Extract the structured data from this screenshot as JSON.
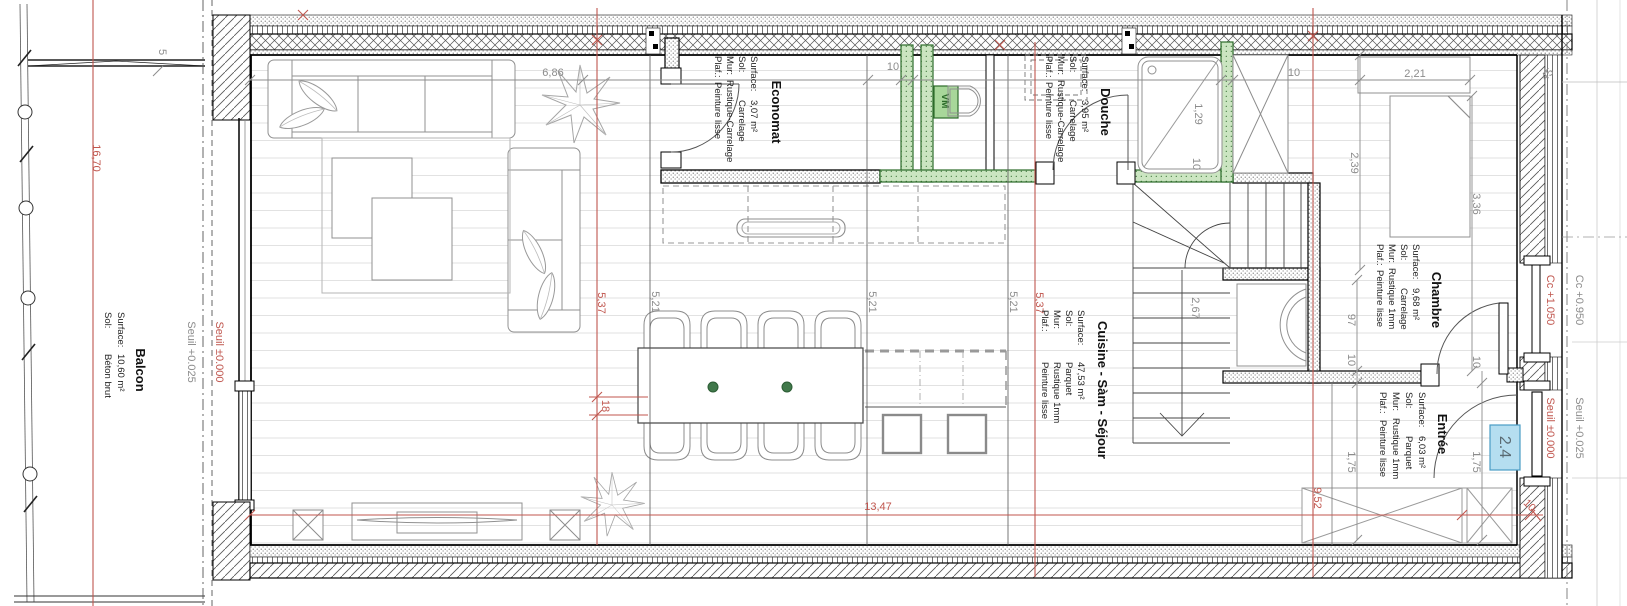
{
  "plan": {
    "rooms": {
      "balcon": {
        "title": "Balcon",
        "rows": [
          {
            "label": "Surface:",
            "value": "10,60 m²"
          },
          {
            "label": "Sol:",
            "value": "Béton brut"
          }
        ]
      },
      "economat": {
        "title": "Economat",
        "rows": [
          {
            "label": "Surface:",
            "value": "3,07 m²"
          },
          {
            "label": "Sol:",
            "value": "Carrelage"
          },
          {
            "label": "Mur:",
            "value": "Rustique-Carrelage"
          },
          {
            "label": "Plaf.:",
            "value": "Peinture lisse"
          }
        ]
      },
      "douche": {
        "title": "Douche",
        "rows": [
          {
            "label": "Surface:",
            "value": "3,95 m²"
          },
          {
            "label": "Sol:",
            "value": "Carrelage"
          },
          {
            "label": "Mur:",
            "value": "Rustique-Carrelage"
          },
          {
            "label": "Plaf.:",
            "value": "Peinture lisse"
          }
        ]
      },
      "cuisine": {
        "title": "Cuisine - Sàm - Séjour",
        "rows": [
          {
            "label": "Surface:",
            "value": "47,53 m²"
          },
          {
            "label": "Sol:",
            "value": "Parquet"
          },
          {
            "label": "Mur:",
            "value": "Rustique 1mm"
          },
          {
            "label": "Plaf.:",
            "value": "Peinture lisse"
          }
        ]
      },
      "chambre": {
        "title": "Chambre",
        "rows": [
          {
            "label": "Surface:",
            "value": "9,68 m²"
          },
          {
            "label": "Sol:",
            "value": "Carrelage"
          },
          {
            "label": "Mur:",
            "value": "Rustique 1mm"
          },
          {
            "label": "Plaf.:",
            "value": "Peinture lisse"
          }
        ]
      },
      "entree": {
        "title": "Entrée",
        "rows": [
          {
            "label": "Surface:",
            "value": "6,03 m²"
          },
          {
            "label": "Sol:",
            "value": "Parquet"
          },
          {
            "label": "Mur:",
            "value": "Rustique 1mm"
          },
          {
            "label": "Plaf.:",
            "value": "Peinture lisse"
          }
        ]
      }
    },
    "levels": {
      "left_gray": "Seuil +0.025",
      "left_red": "Seuil ±0.000",
      "window_red": "Cc +1.050",
      "window_gray": "Cc +0.950",
      "door_red": "Seuil ±0.000",
      "door_gray": "Seuil +0.025"
    },
    "tags": {
      "door": "2.4",
      "vm": "VM"
    },
    "dims_gray": {
      "d5": "5",
      "d686": "6,86",
      "d10_a": "10",
      "d10_b": "10",
      "d129": "1,29",
      "d10_tray": "10",
      "d221": "2,21",
      "d239": "2,39",
      "d336": "3,36",
      "d45": "45",
      "d521_1": "5,21",
      "d521_2": "5,21",
      "d521_3": "5,21",
      "d267": "2,67",
      "d97": "97",
      "d10_c": "10",
      "d10_d": "10",
      "d175_1": "1,75",
      "d175_2": "1,75"
    },
    "dims_red": {
      "d1670": "16,70",
      "d537_1": "5,37",
      "d537_2": "5,37",
      "d18": "18",
      "d1347": "13,47",
      "d952": "9,52",
      "d10_e": "10"
    },
    "colors": {
      "wall_green": "#cbe5c1",
      "green_dark": "#2c6b2a",
      "vm_green": "#a8d79a",
      "dim_red": "#c0564e",
      "dim_gray": "#8c8c8c",
      "door_tag_bg": "#b5def0",
      "door_tag_border": "#4a9cc4"
    }
  }
}
